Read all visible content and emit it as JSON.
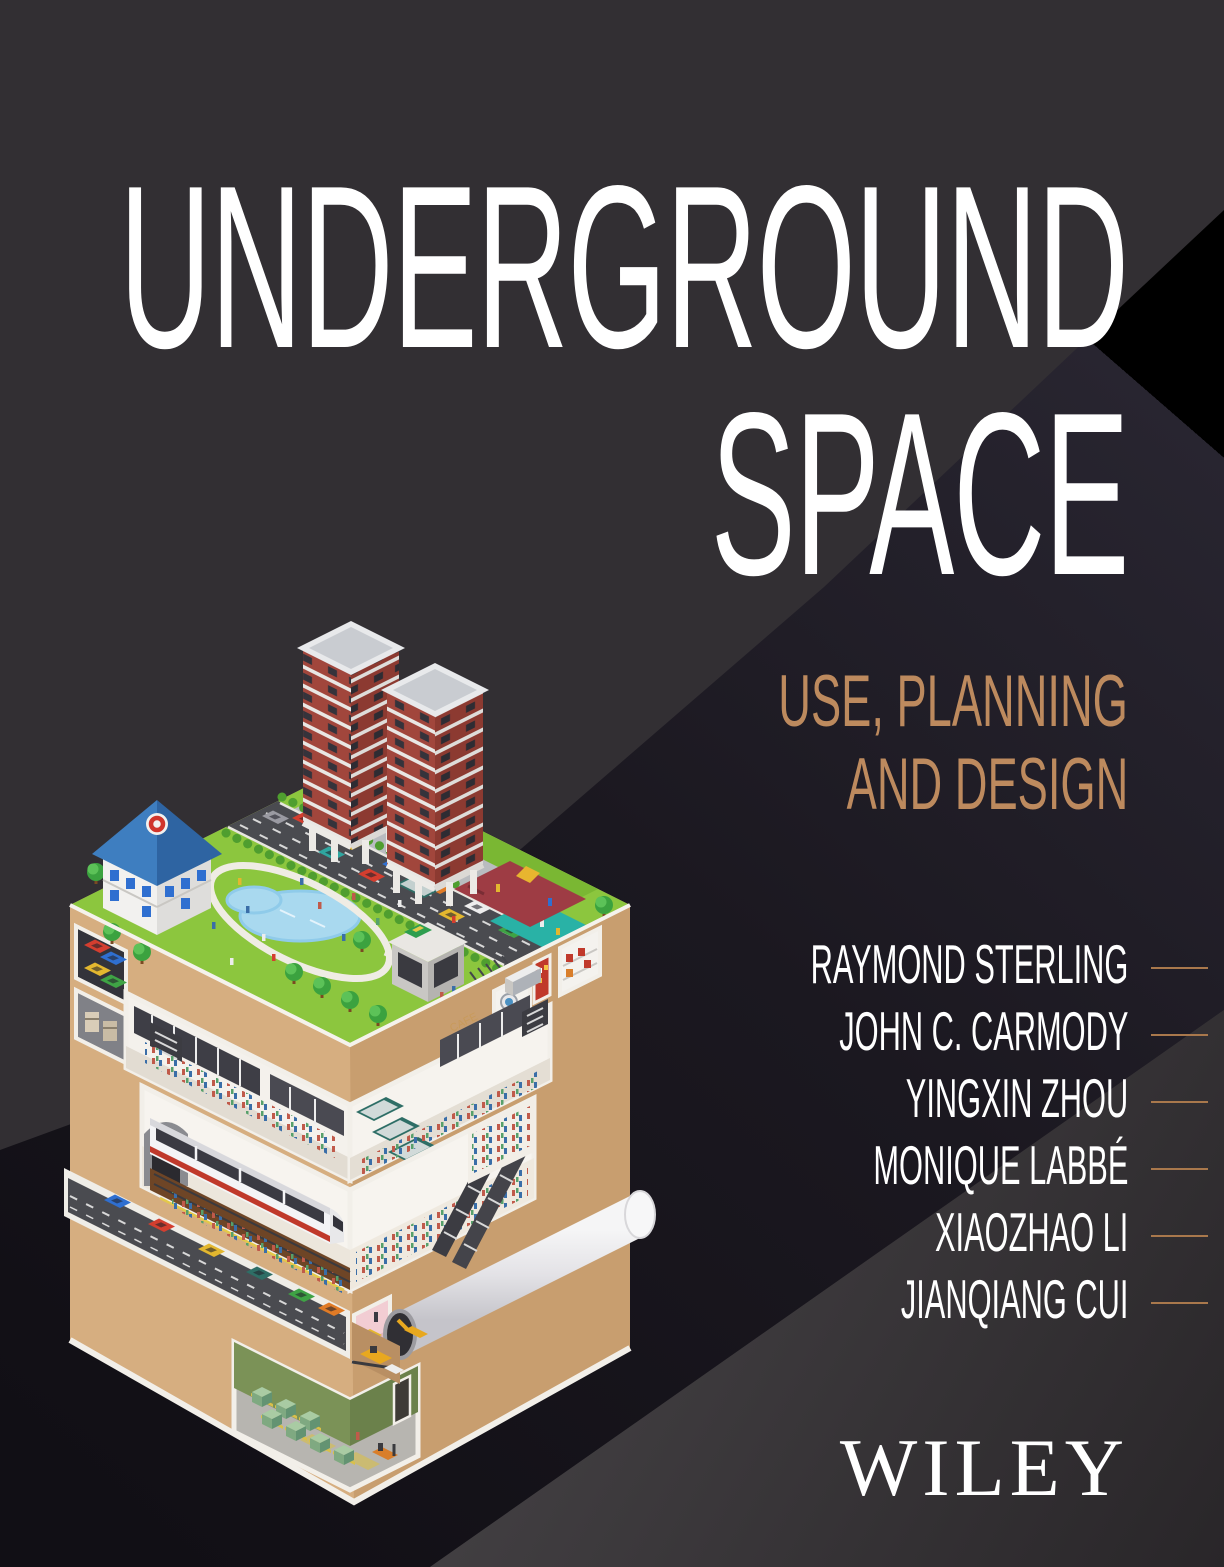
{
  "cover": {
    "title": {
      "line1": "UNDERGROUND",
      "line2": "SPACE"
    },
    "subtitle": {
      "line1": "USE, PLANNING",
      "line2": "AND DESIGN"
    },
    "authors": [
      "RAYMOND STERLING",
      "JOHN C. CARMODY",
      "YINGXIN ZHOU",
      "MONIQUE LABBÉ",
      "XIAOZHAO LI",
      "JIANQIANG CUI"
    ],
    "publisher": "WILEY",
    "illustration": {
      "cafe_sign": "CAFE"
    },
    "colors": {
      "background": "#322F33",
      "background_dark_wedge": "#17141A",
      "background_light_wedge": "#3E3B3E",
      "accent_copper": "#BD8A5E",
      "author_rule": "#A9784C",
      "title_text": "#FFFFFF",
      "earth_light": "#D6AE80",
      "earth_dark": "#C89E6F",
      "grass": "#8CC63E",
      "road": "#4A4B50",
      "pond_water": "#A9D9EF",
      "playground": "#9E3C44",
      "sports_court": "#29B2A6",
      "tunnel_tube": "#E3E2E6",
      "tower_brick": "#A1463C",
      "interior_wall": "#F4F1EC"
    }
  }
}
